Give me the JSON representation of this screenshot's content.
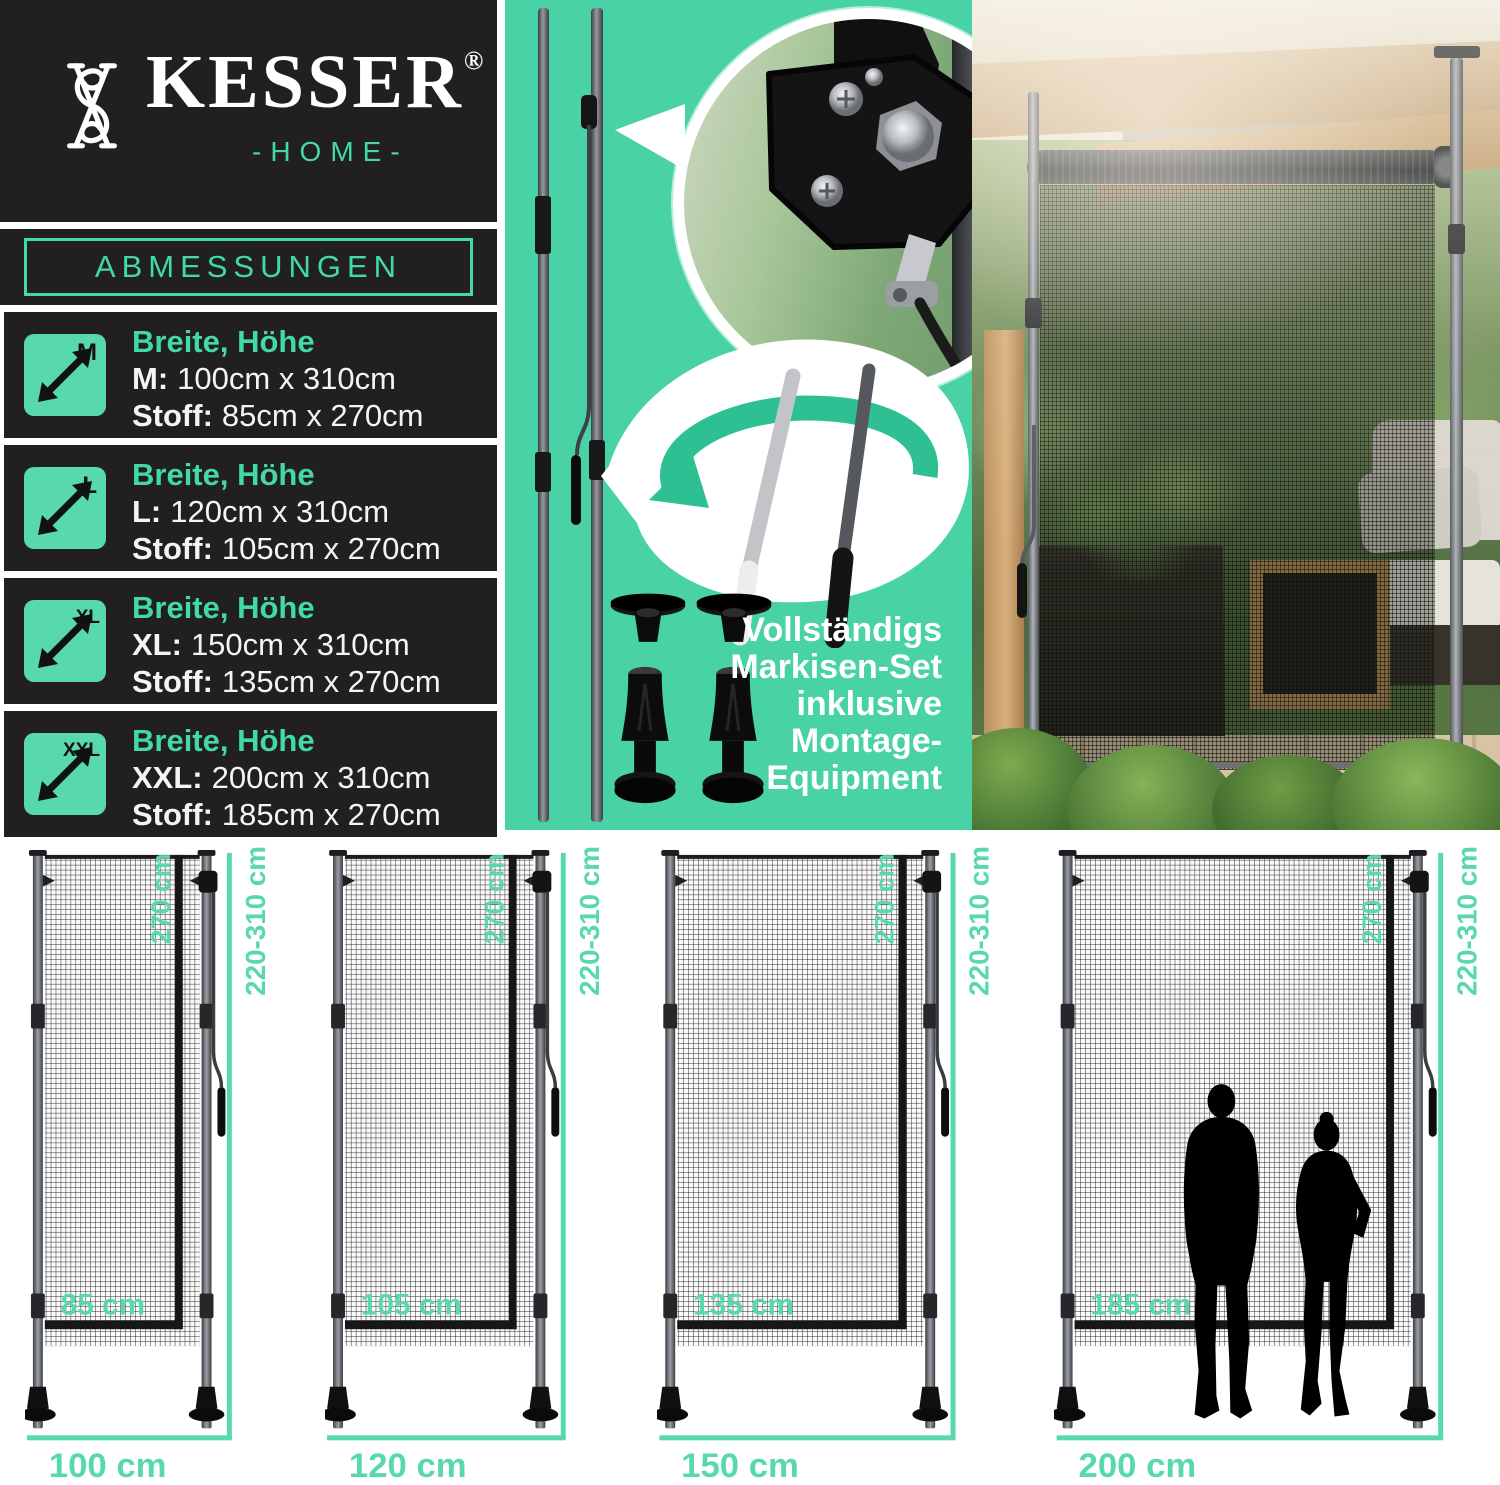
{
  "colors": {
    "panel_black": "#221f1f",
    "brand_teal": "#40d9a7",
    "panel_teal": "#48d2a5",
    "label_teal": "#57d8ad",
    "ribbon_teal": "#2ec093",
    "white": "#ffffff"
  },
  "logo": {
    "name": "KESSER",
    "registered": "®",
    "home": "-HOME-"
  },
  "dimensions_panel": {
    "header": "ABMESSUNGEN",
    "rows": [
      {
        "size": "M",
        "title": "Breite, Höhe",
        "dim_label": "M:",
        "dim_value": "100cm x 310cm",
        "fabric_label": "Stoff:",
        "fabric_value": "85cm x 270cm"
      },
      {
        "size": "L",
        "title": "Breite, Höhe",
        "dim_label": "L:",
        "dim_value": "120cm x 310cm",
        "fabric_label": "Stoff:",
        "fabric_value": "105cm x 270cm"
      },
      {
        "size": "XL",
        "title": "Breite, Höhe",
        "dim_label": "XL:",
        "dim_value": "150cm x 310cm",
        "fabric_label": "Stoff:",
        "fabric_value": "135cm x 270cm"
      },
      {
        "size": "XXL",
        "title": "Breite, Höhe",
        "dim_label": "XXL:",
        "dim_value": "200cm x 310cm",
        "fabric_label": "Stoff:",
        "fabric_value": "185cm x 270cm"
      }
    ]
  },
  "set_panel": {
    "caption_lines": [
      "Vollständigs",
      "Markisen-Set",
      "inklusive",
      "Montage-",
      "Equipment"
    ]
  },
  "diagrams": {
    "shared": {
      "extension_height_label": "220-310 cm",
      "fabric_height_label": "270 cm"
    },
    "items": [
      {
        "size": "M",
        "pole_span": 170,
        "width_label": "100 cm",
        "fabric_width_label": "85 cm",
        "people": false
      },
      {
        "size": "L",
        "pole_span": 204,
        "width_label": "120 cm",
        "fabric_width_label": "105 cm",
        "people": false
      },
      {
        "size": "XL",
        "pole_span": 262,
        "width_label": "150 cm",
        "fabric_width_label": "135 cm",
        "people": false
      },
      {
        "size": "XXL",
        "pole_span": 353,
        "width_label": "200 cm",
        "fabric_width_label": "185 cm",
        "people": true
      }
    ]
  }
}
